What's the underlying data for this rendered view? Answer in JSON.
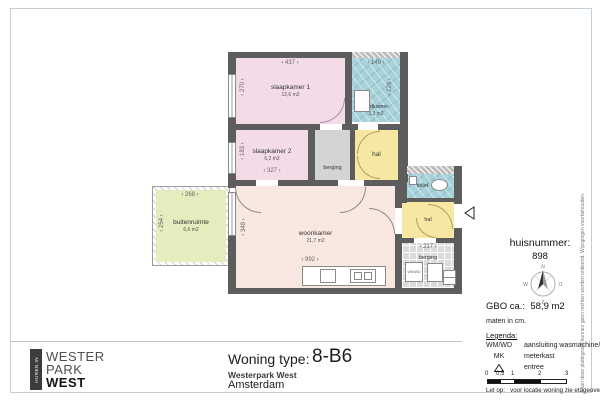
{
  "plan": {
    "rooms": {
      "slaapkamer1": {
        "name": "slaapkamer 1",
        "area": "12,6 m2",
        "w": "437",
        "h": "270"
      },
      "slaapkamer2": {
        "name": "slaapkamer 2",
        "area": "6,2 m2",
        "w": "327",
        "h": "183"
      },
      "badkamer": {
        "name": "badkamer",
        "area": "3,3 m2",
        "w": "149",
        "h": "223"
      },
      "berging_boven": {
        "name": "berging"
      },
      "hal": {
        "name": "hal"
      },
      "woonkamer": {
        "name": "woonkamer",
        "area": "21,7 m2",
        "w": "992",
        "h": "348"
      },
      "buitenruimte": {
        "name": "buitenruimte",
        "area": "6,6 m2",
        "w": "268",
        "h": "254"
      },
      "toilet": {
        "name": "toilet"
      },
      "hal_entree": {
        "name": "hal"
      },
      "berging": {
        "name": "berging",
        "w": "217"
      }
    }
  },
  "arrows": {
    "l": "‹",
    "r": "›"
  },
  "compass": {
    "n": "N",
    "o": "O",
    "z": "Z",
    "w": "W"
  },
  "info": {
    "huisnummer_label": "huisnummer:",
    "huisnummer_value": "898",
    "gbo_label": "GBO ca.:",
    "gbo_value": "58,9 m2",
    "units_note": "maten in cm."
  },
  "legend": {
    "heading": "Legenda:",
    "items": [
      {
        "key": "WM/WD",
        "label": "aansluiting wasmachine/wasdroger"
      },
      {
        "key": "MK",
        "label": "meterkast"
      },
      {
        "key": "",
        "label": "entree"
      }
    ],
    "scale_ticks": [
      "0",
      "0,5",
      "1",
      "2",
      "3"
    ],
    "note_label": "Let op:",
    "note_text": "voor locatie woning zie etageoverzicht."
  },
  "titleblock": {
    "type_label": "Woning type:",
    "type_value": "8-B6",
    "project": "Westerpark West",
    "city": "Amsterdam"
  },
  "logo": {
    "side": "HUREN IN",
    "l1": "WESTER",
    "l2": "PARK",
    "l3": "WEST"
  },
  "disclaimer": "Aan deze plattegrond kunnen geen rechten worden ontleend. Wijzigingen voorbehouden.",
  "colors": {
    "bedroom": "#f3dce8",
    "living": "#f9e8e1",
    "hall": "#f6e8a2",
    "wet_room": "#a7d2da",
    "outdoor": "#e3edbd",
    "storage": "#dbdbdb",
    "wall": "#5d5d5d"
  }
}
